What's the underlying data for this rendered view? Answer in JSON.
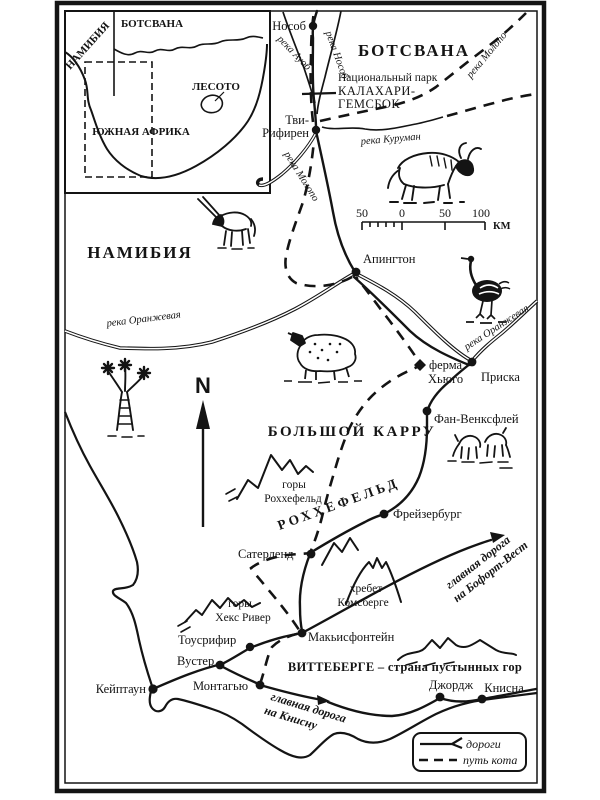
{
  "inset": {
    "namibia": "НАМИБИЯ",
    "botswana": "БОТСВАНА",
    "lesotho": "ЛЕСОТО",
    "south_africa": "ЮЖНАЯ АФРИКА"
  },
  "regions": {
    "botswana": "БОТСВАНА",
    "namibia": "НАМИБИЯ",
    "great_karoo": "БОЛЬШОЙ КАРРУ",
    "roggeveld": "РОХХЕФЕЛЬД",
    "witteberge": "ВИТТЕБЕРГЕ – страна пустынных гор"
  },
  "park": {
    "line1": "Национальный парк",
    "line2": "КАЛАХАРИ-",
    "line3": "ГЕМСБОК"
  },
  "towns": {
    "nosob": "Нособ",
    "twee_rivieren_line1": "Тви-",
    "twee_rivieren_line2": "Рифирен",
    "upington": "Апингтон",
    "prieska": "Приска",
    "vanwyksvlei": "Фан-Венксфлей",
    "hugo_farm_line1": "ферма",
    "hugo_farm_line2": "Хьюго",
    "fraserburg": "Фрейзербург",
    "sutherland": "Сатерленд",
    "matjiesfontein": "Макьисфонтейн",
    "touws_river": "Тоусрифир",
    "worcester": "Вустер",
    "montagu": "Монтагью",
    "cape_town": "Кейптаун",
    "george": "Джордж",
    "knysna": "Книсна"
  },
  "rivers": {
    "auob": "река Ауоб",
    "nossob": "река Нособ",
    "molopo_upper": "река Молопо",
    "molopo_lower": "река Молопо",
    "kuruman": "река Куруман",
    "orange_left": "река Оранжевая",
    "orange_right": "река Оранжевая"
  },
  "mountains": {
    "roggeveld_line1": "горы",
    "roggeveld_line2": "Роххефельд",
    "komsberge_line1": "хребет",
    "komsberge_line2": "Комсберге",
    "hex_river_line1": "горы",
    "hex_river_line2": "Хекс Ривер"
  },
  "road_labels": {
    "beaufort_line1": "главная дорога",
    "beaufort_line2": "на Бофорт-Вест",
    "knysna_line1": "главная дорога",
    "knysna_line2": "на Книсну"
  },
  "scale_bar": {
    "left_50": "50",
    "zero": "0",
    "mid_50": "50",
    "right_100": "100",
    "unit": "КМ"
  },
  "compass": {
    "north": "N"
  },
  "legend": {
    "roads": "дороги",
    "cat_path": "путь кота"
  },
  "icons": {
    "wildebeest": "gnu-wildebeest",
    "ostrich": "ostrich",
    "oryx": "oryx-gemsbok",
    "sheep": "karoo-sheep",
    "springbok": "grazing-springboks",
    "quiver_tree": "quiver-tree",
    "north_arrow": "north-arrow"
  },
  "colors": {
    "ink": "#141414",
    "paper": "#ffffff"
  }
}
